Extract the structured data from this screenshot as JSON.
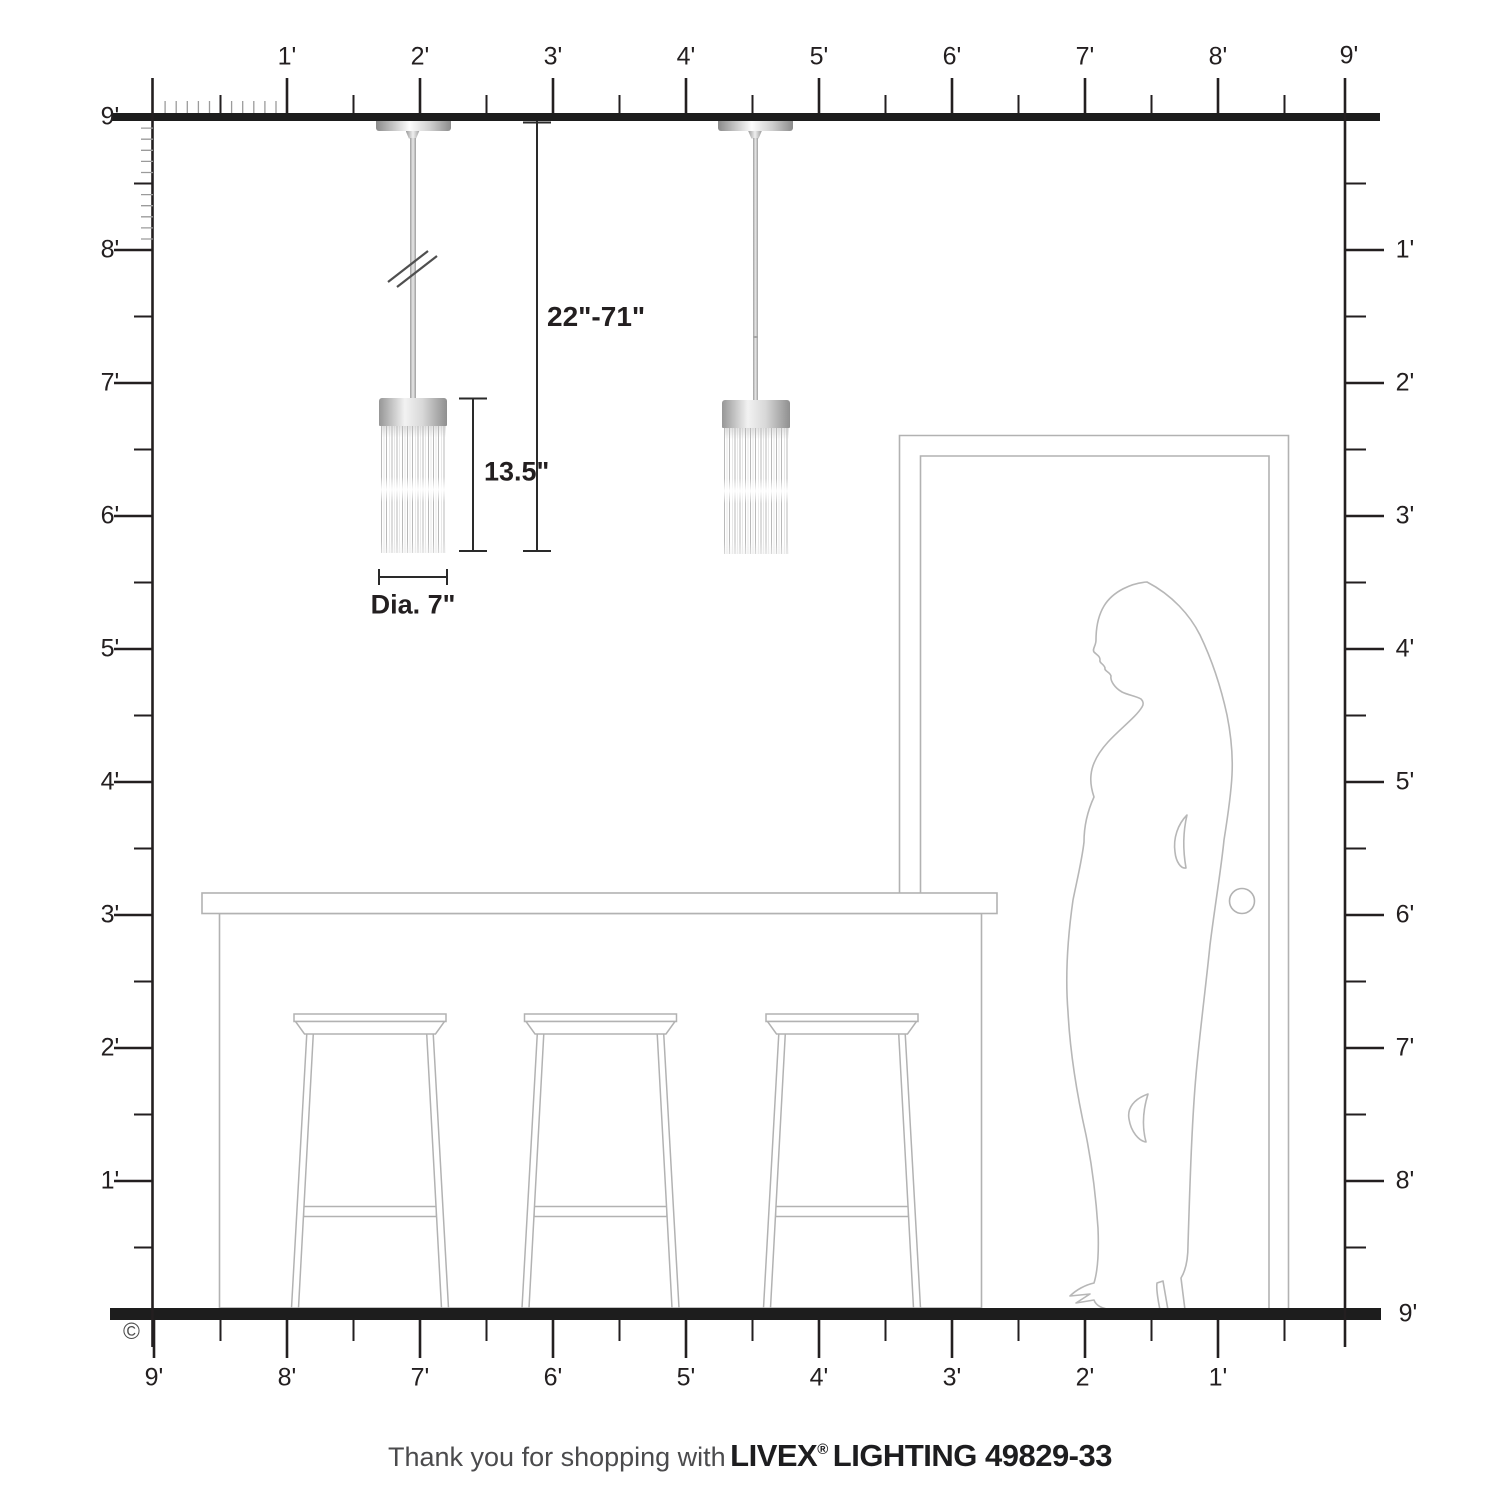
{
  "rulers": {
    "top": {
      "labels": [
        "1'",
        "2'",
        "3'",
        "4'",
        "5'",
        "6'",
        "7'",
        "8'",
        "9'"
      ]
    },
    "left": {
      "labels": [
        "9'",
        "8'",
        "7'",
        "6'",
        "5'",
        "4'",
        "3'",
        "2'",
        "1'"
      ]
    },
    "right": {
      "top_label": "9'",
      "labels": [
        "1'",
        "2'",
        "3'",
        "4'",
        "5'",
        "6'",
        "7'",
        "8'"
      ],
      "floor_label": "9'"
    },
    "bottom": {
      "labels": [
        "9'",
        "8'",
        "7'",
        "6'",
        "5'",
        "4'",
        "3'",
        "2'",
        "1'"
      ]
    }
  },
  "dimensions": {
    "drop_range": "22\"-71\"",
    "shade_height": "13.5\"",
    "shade_diameter": "Dia. 7\""
  },
  "footer": {
    "copyright": "©",
    "tagline_prefix": "Thank you for shopping with",
    "brand": "LIVEX",
    "registered": "®",
    "product": "LIGHTING 49829-33"
  },
  "colors": {
    "furniture_line_gray": "#b2b2b2",
    "ruler_black": "#231f20",
    "pendant_silver": "#c9c9c9"
  }
}
